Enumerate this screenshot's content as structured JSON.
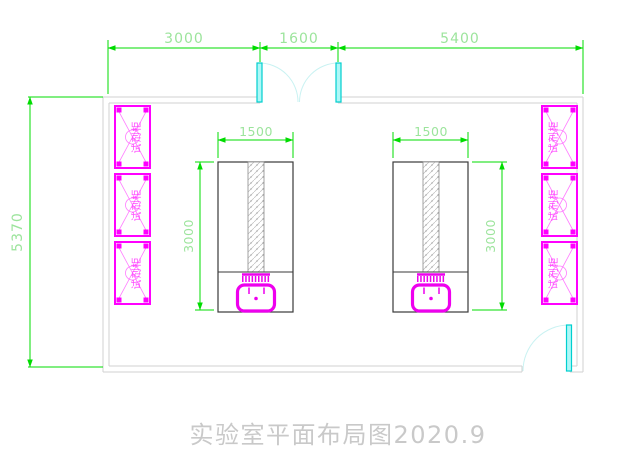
{
  "drawing": {
    "title": "实验室平面布局图2020.9",
    "dimensions": {
      "top": [
        "3000",
        "1600",
        "5400"
      ],
      "left_height": "5370",
      "bench_width": "1500",
      "bench_length": "3000"
    },
    "cabinet_label": "试剂柜",
    "colors": {
      "dimension_line": "#00dc00",
      "dimension_text": "#9ce49c",
      "cabinet": "#ff00ff",
      "wall": "#d2d2d2",
      "bench_outline": "#3a3a3a",
      "door_leaf": "#00e0e0",
      "door_arc": "#c9f2f2",
      "title_text": "#c9c9c9"
    }
  }
}
